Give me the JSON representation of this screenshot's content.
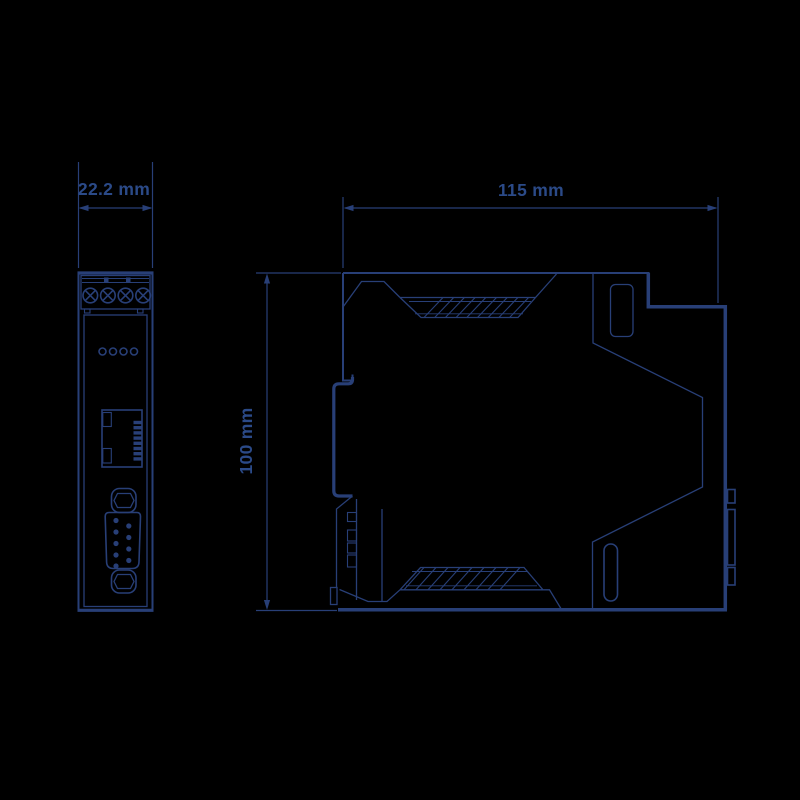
{
  "page": {
    "background_color": "#000000",
    "line_color": "#283f77",
    "text_color": "#2b4a88"
  },
  "drawing": {
    "kind": "technical-dimension-drawing",
    "dimensions": {
      "front_width": {
        "label": "22.2 mm"
      },
      "side_width": {
        "label": "115 mm"
      },
      "height": {
        "label": "100 mm"
      }
    },
    "front_view": {
      "components": [
        "terminal-block",
        "terminal-screws",
        "status-leds",
        "rj45-port",
        "db9-connector"
      ],
      "terminal_screw_count": 4,
      "led_count": 4,
      "db9_pin_count": 9
    },
    "side_view": {
      "components": [
        "vent-grille-top",
        "vent-grille-bottom",
        "din-rail-clip",
        "label-slot",
        "bus-connector-tabs"
      ]
    }
  }
}
